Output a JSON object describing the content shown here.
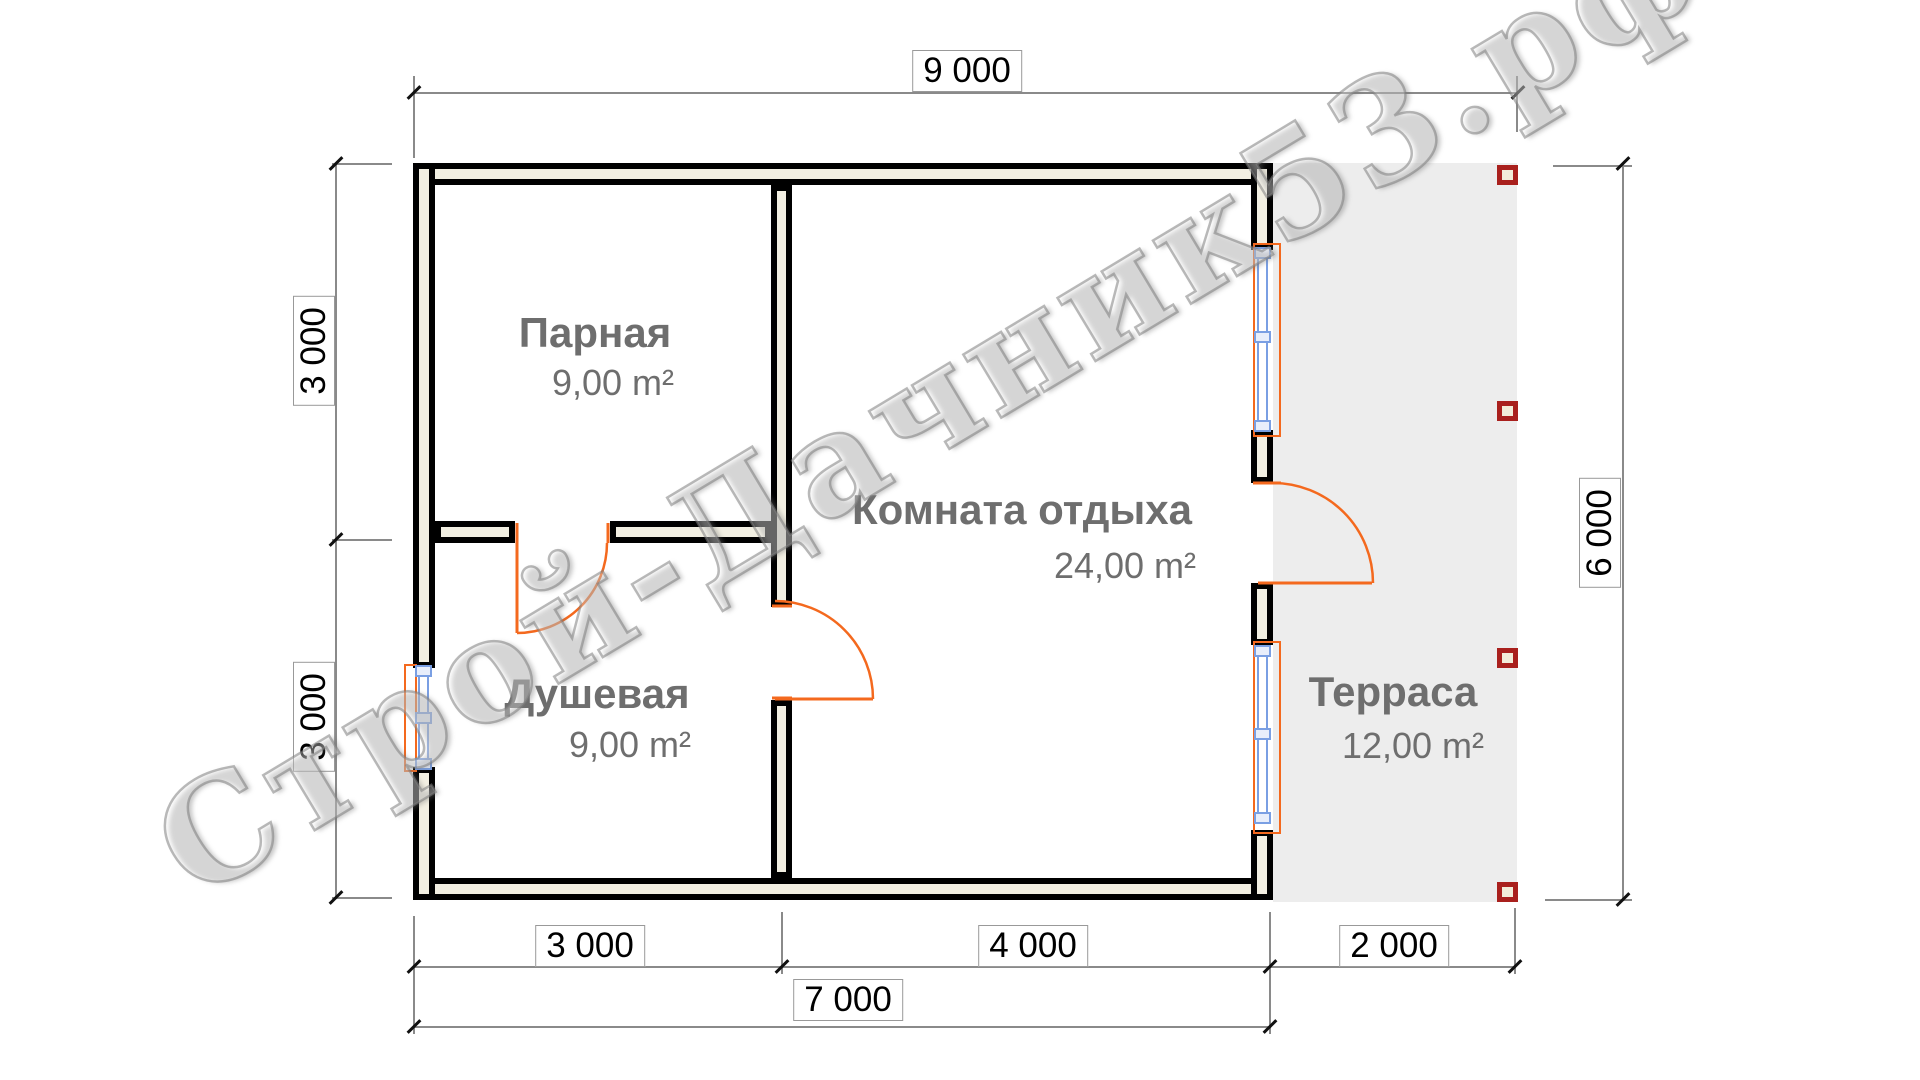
{
  "plan": {
    "watermark": "Строй-Дачник53.рф",
    "rooms": [
      {
        "name": "Парная",
        "area": "9,00 m²"
      },
      {
        "name": "Душевая",
        "area": "9,00 m²"
      },
      {
        "name": "Комната отдыха",
        "area": "24,00 m²"
      },
      {
        "name": "Терраса",
        "area": "12,00 m²"
      }
    ],
    "dims": {
      "top": "9 000",
      "right": "6 000",
      "left_upper": "3 000",
      "left_lower": "3 000",
      "bottom_seg1": "3 000",
      "bottom_seg2": "4 000",
      "bottom_seg3": "2 000",
      "bottom_total": "7 000"
    },
    "colors": {
      "door": "#f4691e",
      "window": "#7a9fe3",
      "wall_fill": "#f2efe2",
      "post_border": "#a9201d",
      "terrace_bg": "#ededed",
      "label_text": "#6e6e6e"
    }
  }
}
